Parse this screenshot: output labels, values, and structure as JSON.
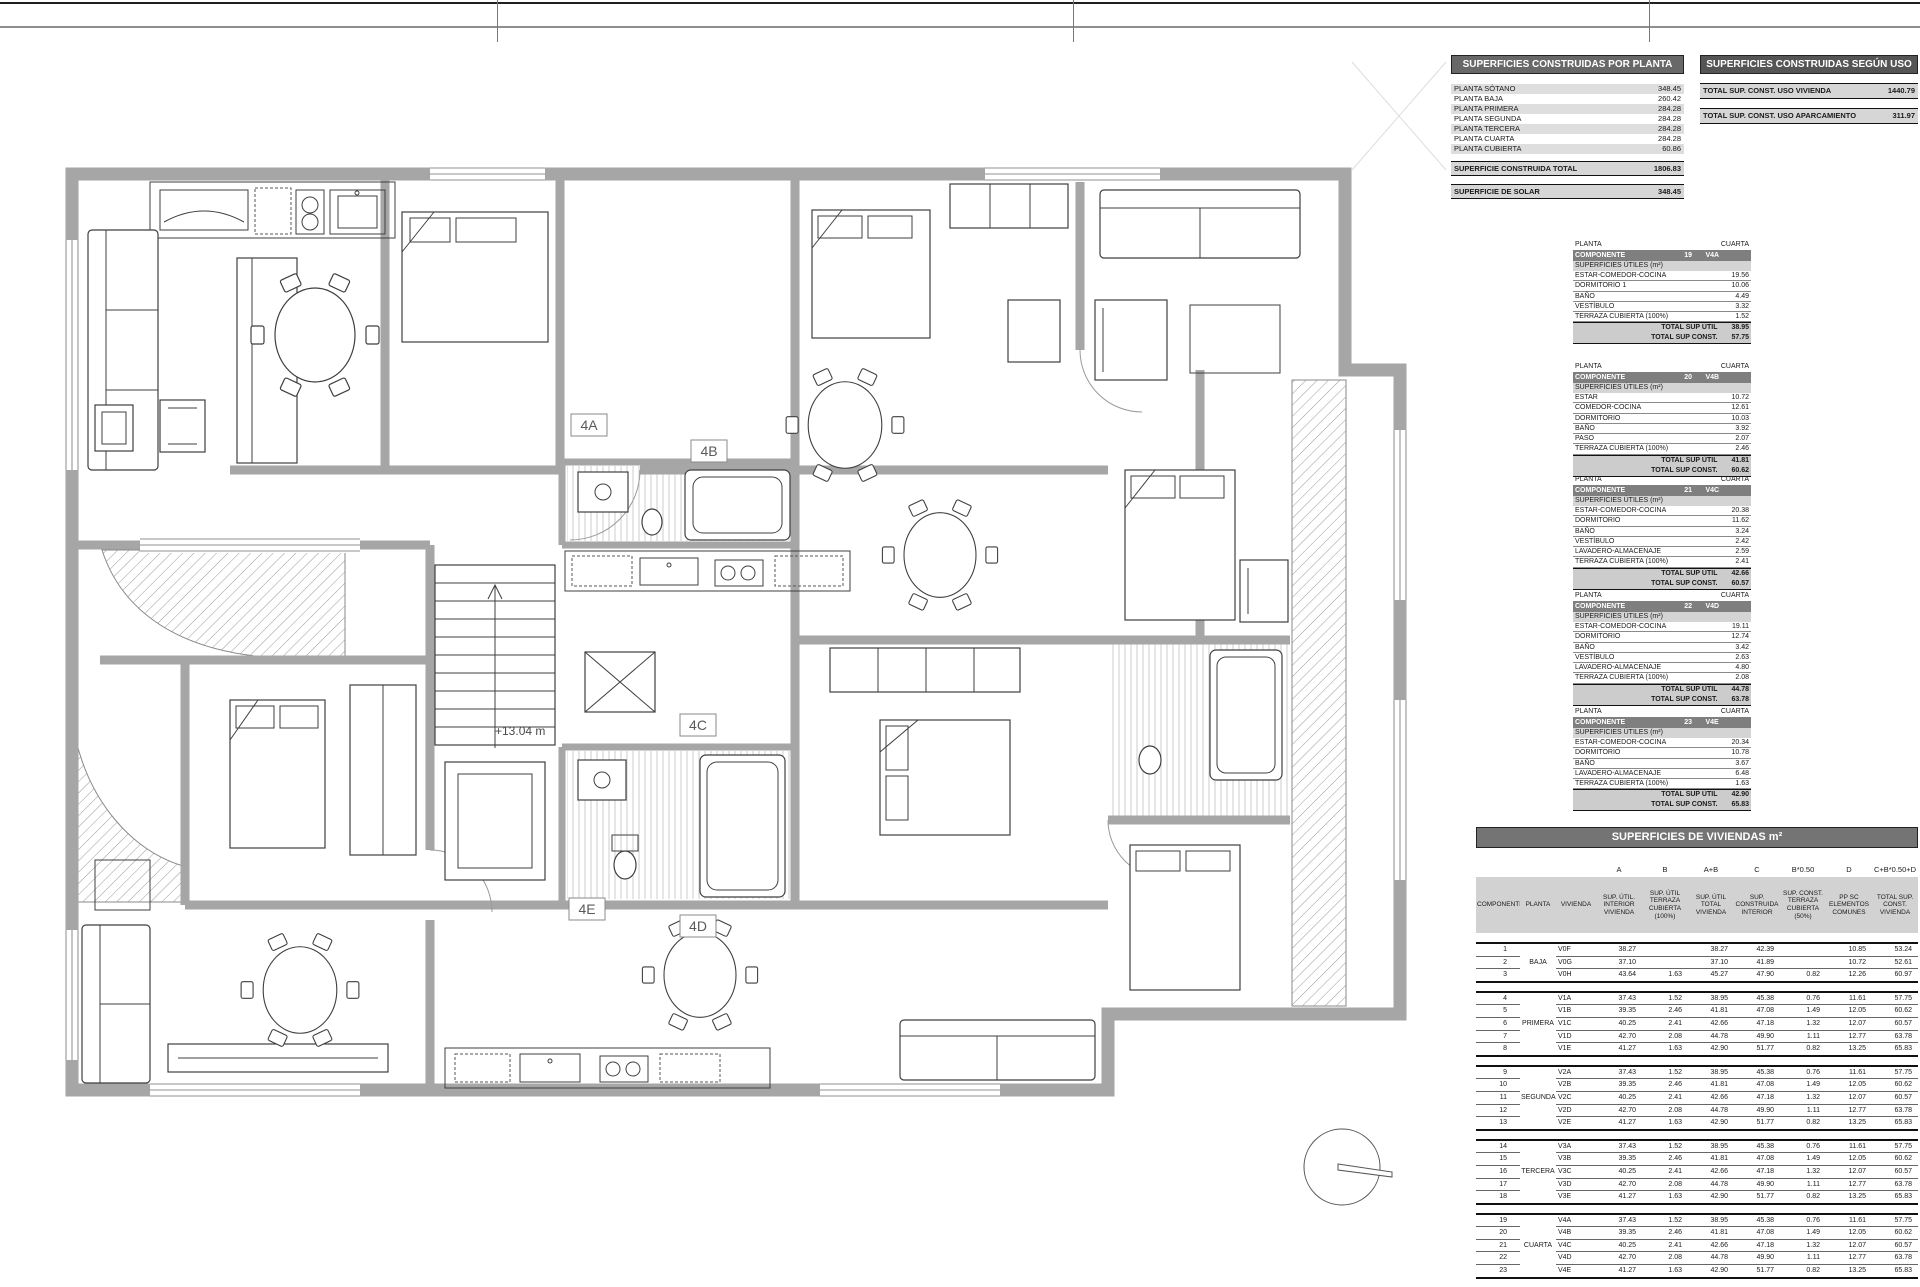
{
  "colors": {
    "title_bar_1": "#686868",
    "title_bar_2": "#555555",
    "title_bar_viviendas": "#747474",
    "component_header_bg": "#7f7f7f",
    "row_shade": "#dedede",
    "total_row_bg": "#d6d6d6",
    "header_row_bg": "#d2d2d2",
    "wall_gray": "#a6a6a6",
    "line_dark": "#111111"
  },
  "floor_plan": {
    "level_annotation": "+13.04 m",
    "units": [
      "4A",
      "4B",
      "4C",
      "4D",
      "4E"
    ]
  },
  "tables": {
    "por_planta": {
      "title": "SUPERFICIES CONSTRUIDAS POR PLANTA",
      "rows": [
        {
          "label": "PLANTA SÓTANO",
          "value": "348.45"
        },
        {
          "label": "PLANTA BAJA",
          "value": "260.42"
        },
        {
          "label": "PLANTA PRIMERA",
          "value": "284.28"
        },
        {
          "label": "PLANTA SEGUNDA",
          "value": "284.28"
        },
        {
          "label": "PLANTA TERCERA",
          "value": "284.28"
        },
        {
          "label": "PLANTA CUARTA",
          "value": "284.28"
        },
        {
          "label": "PLANTA CUBIERTA",
          "value": "60.86"
        }
      ],
      "total": {
        "label": "SUPERFICIE CONSTRUIDA TOTAL",
        "value": "1806.83"
      },
      "solar": {
        "label": "SUPERFICIE DE SOLAR",
        "value": "348.45"
      }
    },
    "segun_uso": {
      "title": "SUPERFICIES CONSTRUIDAS SEGÚN USO",
      "rows": [
        {
          "label": "TOTAL SUP. CONST. USO VIVIENDA",
          "value": "1440.79"
        },
        {
          "label": "TOTAL SUP. CONST. USO APARCAMIENTO",
          "value": "311.97"
        }
      ]
    },
    "componentes": [
      {
        "planta_label": "PLANTA",
        "planta_value": "CUARTA",
        "header_label": "COMPONENTE",
        "numero": "19",
        "codigo": "V4A",
        "section": "SUPERFICIES ÚTILES (m²)",
        "rows": [
          {
            "label": "ESTAR-COMEDOR-COCINA",
            "value": "19.56"
          },
          {
            "label": "DORMITORIO 1",
            "value": "10.06"
          },
          {
            "label": "BAÑO",
            "value": "4.49"
          },
          {
            "label": "VESTÍBULO",
            "value": "3.32"
          },
          {
            "label": "TERRAZA CUBIERTA (100%)",
            "value": "1.52"
          }
        ],
        "total_util": {
          "label": "TOTAL SUP ÚTIL",
          "value": "38.95"
        },
        "total_const": {
          "label": "TOTAL SUP CONST.",
          "value": "57.75"
        }
      },
      {
        "planta_label": "PLANTA",
        "planta_value": "CUARTA",
        "header_label": "COMPONENTE",
        "numero": "20",
        "codigo": "V4B",
        "section": "SUPERFICIES ÚTILES (m²)",
        "rows": [
          {
            "label": "ESTAR",
            "value": "10.72"
          },
          {
            "label": "COMEDOR-COCINA",
            "value": "12.61"
          },
          {
            "label": "DORMITORIO",
            "value": "10.03"
          },
          {
            "label": "BAÑO",
            "value": "3.92"
          },
          {
            "label": "PASO",
            "value": "2.07"
          },
          {
            "label": "TERRAZA CUBIERTA (100%)",
            "value": "2.46"
          }
        ],
        "total_util": {
          "label": "TOTAL SUP ÚTIL",
          "value": "41.81"
        },
        "total_const": {
          "label": "TOTAL SUP CONST.",
          "value": "60.62"
        }
      },
      {
        "planta_label": "PLANTA",
        "planta_value": "CUARTA",
        "header_label": "COMPONENTE",
        "numero": "21",
        "codigo": "V4C",
        "section": "SUPERFICIES ÚTILES (m²)",
        "rows": [
          {
            "label": "ESTAR-COMEDOR-COCINA",
            "value": "20.38"
          },
          {
            "label": "DORMITORIO",
            "value": "11.62"
          },
          {
            "label": "BAÑO",
            "value": "3.24"
          },
          {
            "label": "VESTÍBULO",
            "value": "2.42"
          },
          {
            "label": "LAVADERO-ALMACENAJE",
            "value": "2.59"
          },
          {
            "label": "TERRAZA CUBIERTA (100%)",
            "value": "2.41"
          }
        ],
        "total_util": {
          "label": "TOTAL SUP ÚTIL",
          "value": "42.66"
        },
        "total_const": {
          "label": "TOTAL SUP CONST.",
          "value": "60.57"
        }
      },
      {
        "planta_label": "PLANTA",
        "planta_value": "CUARTA",
        "header_label": "COMPONENTE",
        "numero": "22",
        "codigo": "V4D",
        "section": "SUPERFICIES ÚTILES (m²)",
        "rows": [
          {
            "label": "ESTAR-COMEDOR-COCINA",
            "value": "19.11"
          },
          {
            "label": "DORMITORIO",
            "value": "12.74"
          },
          {
            "label": "BAÑO",
            "value": "3.42"
          },
          {
            "label": "VESTÍBULO",
            "value": "2.63"
          },
          {
            "label": "LAVADERO-ALMACENAJE",
            "value": "4.80"
          },
          {
            "label": "TERRAZA CUBIERTA (100%)",
            "value": "2.08"
          }
        ],
        "total_util": {
          "label": "TOTAL SUP ÚTIL",
          "value": "44.78"
        },
        "total_const": {
          "label": "TOTAL SUP CONST.",
          "value": "63.78"
        }
      },
      {
        "planta_label": "PLANTA",
        "planta_value": "CUARTA",
        "header_label": "COMPONENTE",
        "numero": "23",
        "codigo": "V4E",
        "section": "SUPERFICIES ÚTILES (m²)",
        "rows": [
          {
            "label": "ESTAR-COMEDOR-COCINA",
            "value": "20.34"
          },
          {
            "label": "DORMITORIO",
            "value": "10.78"
          },
          {
            "label": "BAÑO",
            "value": "3.67"
          },
          {
            "label": "LAVADERO-ALMACENAJE",
            "value": "6.48"
          },
          {
            "label": "TERRAZA CUBIERTA (100%)",
            "value": "1.63"
          }
        ],
        "total_util": {
          "label": "TOTAL SUP ÚTIL",
          "value": "42.90"
        },
        "total_const": {
          "label": "TOTAL SUP CONST.",
          "value": "65.83"
        }
      }
    ],
    "viviendas": {
      "title": "SUPERFICIES DE VIVIENDAS m²",
      "formula_row": [
        "",
        "",
        "",
        "A",
        "B",
        "A+B",
        "C",
        "B*0.50",
        "D",
        "C+B*0.50+D"
      ],
      "headers": [
        "COMPONENTE",
        "PLANTA",
        "VIVIENDA",
        "SUP. ÚTIL. INTERIOR VIVIENDA",
        "SUP. ÚTIL TERRAZA CUBIERTA (100%)",
        "SUP. ÚTIL TOTAL VIVIENDA",
        "SUP. CONSTRUIDA INTERIOR",
        "SUP. CONST. TERRAZA CUBIERTA (50%)",
        "PP SC ELEMENTOS COMUNES",
        "TOTAL SUP. CONST. VIVIENDA"
      ],
      "groups": [
        {
          "planta": "BAJA",
          "rows": [
            [
              "1",
              "V0F",
              "38.27",
              "",
              "38.27",
              "42.39",
              "",
              "10.85",
              "53.24"
            ],
            [
              "2",
              "V0G",
              "37.10",
              "",
              "37.10",
              "41.89",
              "",
              "10.72",
              "52.61"
            ],
            [
              "3",
              "V0H",
              "43.64",
              "1.63",
              "45.27",
              "47.90",
              "0.82",
              "12.26",
              "60.97"
            ]
          ]
        },
        {
          "planta": "PRIMERA",
          "rows": [
            [
              "4",
              "V1A",
              "37.43",
              "1.52",
              "38.95",
              "45.38",
              "0.76",
              "11.61",
              "57.75"
            ],
            [
              "5",
              "V1B",
              "39.35",
              "2.46",
              "41.81",
              "47.08",
              "1.49",
              "12.05",
              "60.62"
            ],
            [
              "6",
              "V1C",
              "40.25",
              "2.41",
              "42.66",
              "47.18",
              "1.32",
              "12.07",
              "60.57"
            ],
            [
              "7",
              "V1D",
              "42.70",
              "2.08",
              "44.78",
              "49.90",
              "1.11",
              "12.77",
              "63.78"
            ],
            [
              "8",
              "V1E",
              "41.27",
              "1.63",
              "42.90",
              "51.77",
              "0.82",
              "13.25",
              "65.83"
            ]
          ]
        },
        {
          "planta": "SEGUNDA",
          "rows": [
            [
              "9",
              "V2A",
              "37.43",
              "1.52",
              "38.95",
              "45.38",
              "0.76",
              "11.61",
              "57.75"
            ],
            [
              "10",
              "V2B",
              "39.35",
              "2.46",
              "41.81",
              "47.08",
              "1.49",
              "12.05",
              "60.62"
            ],
            [
              "11",
              "V2C",
              "40.25",
              "2.41",
              "42.66",
              "47.18",
              "1.32",
              "12.07",
              "60.57"
            ],
            [
              "12",
              "V2D",
              "42.70",
              "2.08",
              "44.78",
              "49.90",
              "1.11",
              "12.77",
              "63.78"
            ],
            [
              "13",
              "V2E",
              "41.27",
              "1.63",
              "42.90",
              "51.77",
              "0.82",
              "13.25",
              "65.83"
            ]
          ]
        },
        {
          "planta": "TERCERA",
          "rows": [
            [
              "14",
              "V3A",
              "37.43",
              "1.52",
              "38.95",
              "45.38",
              "0.76",
              "11.61",
              "57.75"
            ],
            [
              "15",
              "V3B",
              "39.35",
              "2.46",
              "41.81",
              "47.08",
              "1.49",
              "12.05",
              "60.62"
            ],
            [
              "16",
              "V3C",
              "40.25",
              "2.41",
              "42.66",
              "47.18",
              "1.32",
              "12.07",
              "60.57"
            ],
            [
              "17",
              "V3D",
              "42.70",
              "2.08",
              "44.78",
              "49.90",
              "1.11",
              "12.77",
              "63.78"
            ],
            [
              "18",
              "V3E",
              "41.27",
              "1.63",
              "42.90",
              "51.77",
              "0.82",
              "13.25",
              "65.83"
            ]
          ]
        },
        {
          "planta": "CUARTA",
          "rows": [
            [
              "19",
              "V4A",
              "37.43",
              "1.52",
              "38.95",
              "45.38",
              "0.76",
              "11.61",
              "57.75"
            ],
            [
              "20",
              "V4B",
              "39.35",
              "2.46",
              "41.81",
              "47.08",
              "1.49",
              "12.05",
              "60.62"
            ],
            [
              "21",
              "V4C",
              "40.25",
              "2.41",
              "42.66",
              "47.18",
              "1.32",
              "12.07",
              "60.57"
            ],
            [
              "22",
              "V4D",
              "42.70",
              "2.08",
              "44.78",
              "49.90",
              "1.11",
              "12.77",
              "63.78"
            ],
            [
              "23",
              "V4E",
              "41.27",
              "1.63",
              "42.90",
              "51.77",
              "0.82",
              "13.25",
              "65.83"
            ]
          ]
        }
      ]
    }
  }
}
